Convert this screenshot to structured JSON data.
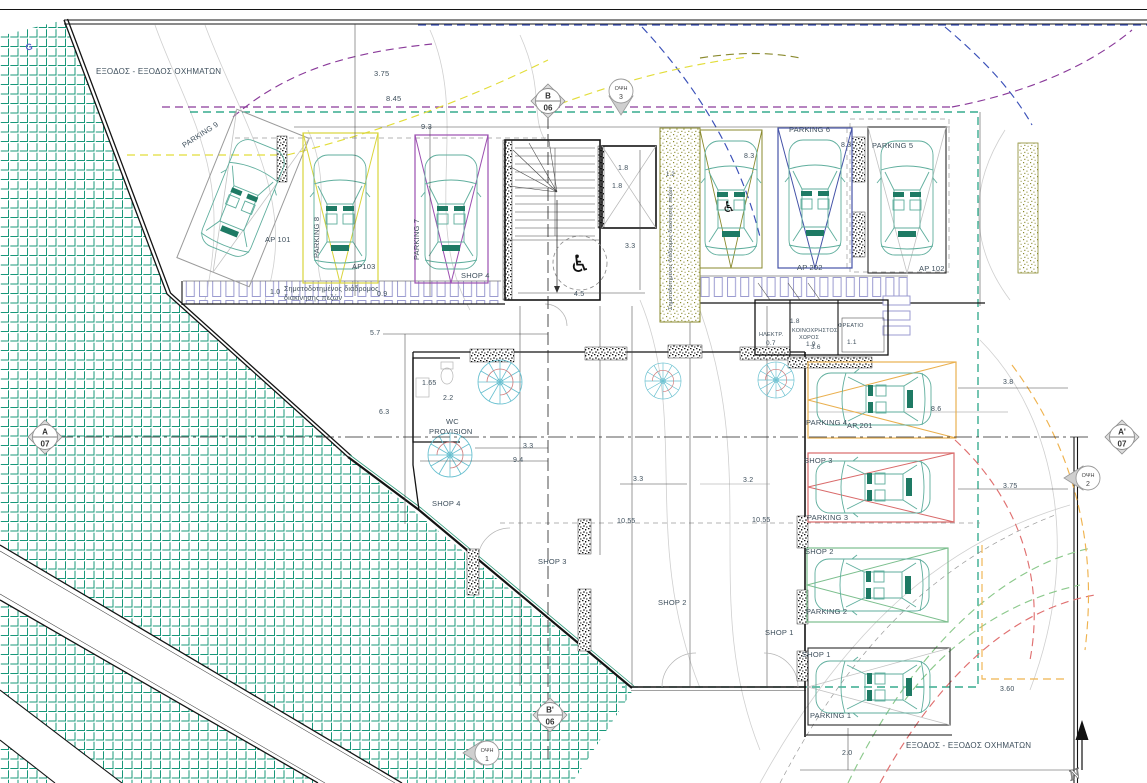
{
  "drawing": {
    "type": "ground-floor-parking-site-plan"
  },
  "colors": {
    "hatch_green": "#18987a",
    "property_teal": "#0f9a78",
    "bay_yellow": "#d9d43c",
    "bay_purple": "#9b4fb0",
    "bay_blue": "#4553a8",
    "bay_olive": "#8a8a2e",
    "bay_orange": "#eab04f",
    "bay_red": "#d96a6a",
    "bay_green": "#7cbf8e",
    "bay_gray": "#9a9a9a",
    "bay_black": "#2a2a2a",
    "car_teal": "#5fae9d",
    "crossing_lavender": "#9b9bd0",
    "dash_blue": "#3a50b8",
    "dash_purple": "#8a3a9a",
    "dash_yellow": "#e2dd3a",
    "dash_green": "#8cc98c",
    "dash_red": "#e07070",
    "dash_orange": "#efb34f",
    "text": "#3e4f5c"
  },
  "icons": {
    "accessible": "♿"
  },
  "north": {
    "label": "N"
  },
  "stamp": {
    "text": "G"
  },
  "section_markers": [
    {
      "top": "B",
      "bottom": "06"
    },
    {
      "top": "B'",
      "bottom": "06"
    },
    {
      "top": "A",
      "bottom": "07"
    },
    {
      "top": "A'",
      "bottom": "07"
    }
  ],
  "view_markers": [
    {
      "name": "ΟΨΗ",
      "num": "3"
    },
    {
      "name": "ΟΨΗ",
      "num": "2"
    },
    {
      "name": "ΟΨΗ",
      "num": "1"
    }
  ],
  "labels": [
    {
      "text": "ΕΞΟΔΟΣ - ΕΞΟΔΟΣ ΟΧΗΜΑΤΩΝ",
      "x": 96,
      "y": 68,
      "size": 8,
      "name": "exit-label-top"
    },
    {
      "text": "3.75",
      "x": 374,
      "y": 70,
      "name": "dim-375-top"
    },
    {
      "text": "8.45",
      "x": 386,
      "y": 95,
      "name": "dim-845"
    },
    {
      "text": "9.3",
      "x": 421,
      "y": 123,
      "name": "dim-93"
    },
    {
      "text": "PARKING 9",
      "x": 181,
      "y": 143,
      "rot": -33,
      "name": "parking-9-label"
    },
    {
      "text": "AP 101",
      "x": 265,
      "y": 236,
      "name": "ap-101-label"
    },
    {
      "text": "PARKING 8",
      "x": 313,
      "y": 258,
      "rot": -90,
      "name": "parking-8-label"
    },
    {
      "text": "AP103",
      "x": 352,
      "y": 263,
      "name": "ap-103-label"
    },
    {
      "text": "PARKING 7",
      "x": 413,
      "y": 260,
      "rot": -90,
      "name": "parking-7-label"
    },
    {
      "text": "SHOP 4",
      "x": 461,
      "y": 272,
      "name": "shop-4-tag"
    },
    {
      "text": "Σηματοδοτημένος διάδρομος",
      "x": 284,
      "y": 286,
      "size": 7,
      "name": "ped-corridor-line1"
    },
    {
      "text": "διακίνησης πεζών",
      "x": 284,
      "y": 295,
      "size": 7,
      "name": "ped-corridor-line2"
    },
    {
      "text": "1.0",
      "x": 270,
      "y": 289,
      "size": 7,
      "name": "dim-10"
    },
    {
      "text": "0.9",
      "x": 377,
      "y": 291,
      "size": 7,
      "name": "dim-09"
    },
    {
      "text": "1.8",
      "x": 618,
      "y": 165,
      "size": 7,
      "name": "dim-18-a"
    },
    {
      "text": "1.8",
      "x": 612,
      "y": 183,
      "size": 7,
      "name": "dim-18-b"
    },
    {
      "text": "3.3",
      "x": 625,
      "y": 243,
      "size": 7,
      "name": "dim-33-lift"
    },
    {
      "text": "4.5",
      "x": 574,
      "y": 291,
      "size": 7,
      "name": "dim-45"
    },
    {
      "text": "PARKING 6",
      "x": 789,
      "y": 126,
      "name": "parking-6-label"
    },
    {
      "text": "8.3",
      "x": 744,
      "y": 153,
      "size": 7,
      "name": "dim-83-a"
    },
    {
      "text": "8.3",
      "x": 841,
      "y": 142,
      "size": 7,
      "name": "dim-83-b"
    },
    {
      "text": "PARKING 5",
      "x": 872,
      "y": 142,
      "name": "parking-5-label"
    },
    {
      "text": "AP 202",
      "x": 797,
      "y": 264,
      "name": "ap-202-label"
    },
    {
      "text": "AP 102",
      "x": 919,
      "y": 265,
      "name": "ap-102-label"
    },
    {
      "text": "Σηματοδοτημένος διάδρομος διακίνησης πεζών",
      "x": 669,
      "y": 310,
      "rot": -90,
      "size": 5.5,
      "name": "ramp-ped-label"
    },
    {
      "text": "1.2",
      "x": 666,
      "y": 172,
      "size": 6,
      "name": "dim-12"
    },
    {
      "text": "ΗΛΕΚΤΡ.",
      "x": 759,
      "y": 333,
      "size": 5.5,
      "name": "room-electrical-label"
    },
    {
      "text": "0.7",
      "x": 766,
      "y": 341,
      "size": 6.5,
      "name": "dim-07"
    },
    {
      "text": "ΚΟΙΝΟΧΡΗΣΤΟΣ",
      "x": 792,
      "y": 329,
      "size": 5.5,
      "name": "room-common-line1"
    },
    {
      "text": "ΧΩΡΟΣ",
      "x": 799,
      "y": 336,
      "size": 5.5,
      "name": "room-common-line2"
    },
    {
      "text": "1.9",
      "x": 806,
      "y": 342,
      "size": 6.5,
      "name": "dim-19"
    },
    {
      "text": "ΦΡΕΑΤΙΟ",
      "x": 838,
      "y": 324,
      "size": 5.5,
      "name": "room-shaft-label"
    },
    {
      "text": "1.1",
      "x": 847,
      "y": 340,
      "size": 6.5,
      "name": "dim-11"
    },
    {
      "text": "1.8",
      "x": 790,
      "y": 319,
      "size": 6.5,
      "name": "dim-18-c"
    },
    {
      "text": "3.6",
      "x": 811,
      "y": 345,
      "size": 6.5,
      "name": "dim-36"
    },
    {
      "text": "1.65",
      "x": 422,
      "y": 380,
      "size": 7,
      "name": "dim-165"
    },
    {
      "text": "2.2",
      "x": 443,
      "y": 395,
      "size": 7,
      "name": "dim-22"
    },
    {
      "text": "WC",
      "x": 446,
      "y": 418,
      "name": "wc-label-line1"
    },
    {
      "text": "PROVISION",
      "x": 429,
      "y": 428,
      "name": "wc-label-line2"
    },
    {
      "text": "5.7",
      "x": 370,
      "y": 330,
      "size": 7,
      "name": "dim-57"
    },
    {
      "text": "6.3",
      "x": 379,
      "y": 409,
      "size": 7,
      "name": "dim-63"
    },
    {
      "text": "3.3",
      "x": 523,
      "y": 443,
      "size": 7,
      "name": "dim-33-mid"
    },
    {
      "text": "9.4",
      "x": 513,
      "y": 457,
      "size": 7,
      "name": "dim-94"
    },
    {
      "text": "3.3",
      "x": 633,
      "y": 476,
      "size": 7,
      "name": "dim-33-shop"
    },
    {
      "text": "3.2",
      "x": 743,
      "y": 477,
      "size": 7,
      "name": "dim-32"
    },
    {
      "text": "10.55",
      "x": 617,
      "y": 518,
      "size": 7,
      "name": "dim-1055-a"
    },
    {
      "text": "10.55",
      "x": 752,
      "y": 517,
      "size": 7,
      "name": "dim-1055-b"
    },
    {
      "text": "SHOP 4",
      "x": 432,
      "y": 500,
      "name": "shop-4-label"
    },
    {
      "text": "SHOP 3",
      "x": 538,
      "y": 558,
      "name": "shop-3-label"
    },
    {
      "text": "SHOP 2",
      "x": 658,
      "y": 599,
      "name": "shop-2-label"
    },
    {
      "text": "SHOP 1",
      "x": 765,
      "y": 629,
      "name": "shop-1-label"
    },
    {
      "text": "PARKING 4",
      "x": 806,
      "y": 419,
      "name": "parking-4-label"
    },
    {
      "text": "AP 201",
      "x": 847,
      "y": 422,
      "name": "ap-201-label"
    },
    {
      "text": "8.6",
      "x": 931,
      "y": 406,
      "size": 7,
      "name": "dim-86"
    },
    {
      "text": "3.8",
      "x": 1003,
      "y": 379,
      "size": 7,
      "name": "dim-38"
    },
    {
      "text": "SHOP 3",
      "x": 804,
      "y": 457,
      "name": "shop-3-tag"
    },
    {
      "text": "3.75",
      "x": 1003,
      "y": 483,
      "size": 7,
      "name": "dim-375-right"
    },
    {
      "text": "PARKING 3",
      "x": 807,
      "y": 514,
      "name": "parking-3-label"
    },
    {
      "text": "SHOP 2",
      "x": 805,
      "y": 548,
      "name": "shop-2-tag"
    },
    {
      "text": "PARKING 2",
      "x": 806,
      "y": 608,
      "name": "parking-2-label"
    },
    {
      "text": "SHOP 1",
      "x": 802,
      "y": 651,
      "name": "shop-1-tag"
    },
    {
      "text": "PARKING 1",
      "x": 810,
      "y": 712,
      "name": "parking-1-label"
    },
    {
      "text": "3.60",
      "x": 1000,
      "y": 686,
      "size": 7,
      "name": "dim-360"
    },
    {
      "text": "2.0",
      "x": 842,
      "y": 750,
      "size": 7,
      "name": "dim-20"
    },
    {
      "text": "ΕΞΟΔΟΣ - ΕΞΟΔΟΣ ΟΧΗΜΑΤΩΝ",
      "x": 906,
      "y": 742,
      "size": 8,
      "name": "exit-label-bottom"
    }
  ]
}
